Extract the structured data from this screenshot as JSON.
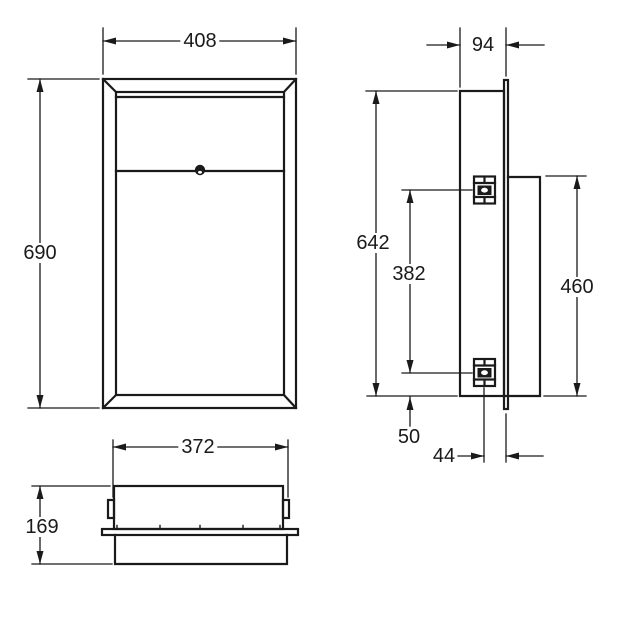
{
  "colors": {
    "line": "#1a1a1a",
    "background": "#ffffff"
  },
  "views": {
    "front": {
      "width": "408",
      "height": "690"
    },
    "side": {
      "depth": "94",
      "body_height": "642",
      "bracket_spacing": "382",
      "panel_height": "460",
      "bottom_offset": "50",
      "bracket_offset": "44"
    },
    "bottom": {
      "body_width": "372",
      "depth": "169"
    }
  }
}
